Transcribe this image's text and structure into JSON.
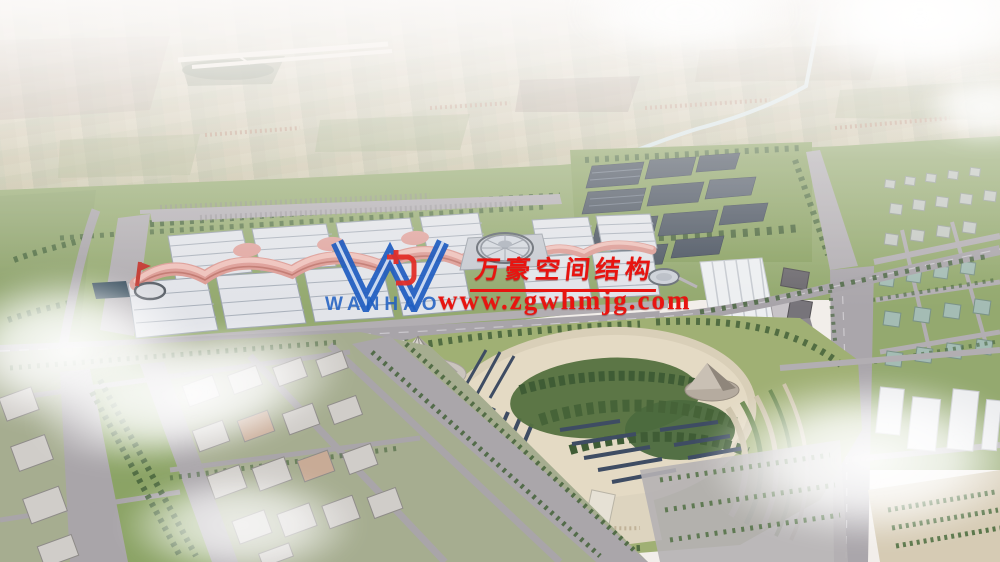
{
  "watermark": {
    "logo_text": "WANHAO",
    "brand_name": "万豪空间结构",
    "website": "www.zgwhmjg.com",
    "text_color": "#e81410",
    "logo_blue": "#1d5ec2",
    "logo_accent_red": "#e22e28"
  },
  "palette": {
    "sky_haze": "#f5f2f0",
    "farmland_tan": "#d9d2bd",
    "greenery": "#94a96f",
    "tree_dark": "#44623a",
    "road_grey": "#a8a4a9",
    "hall_roof_white": "#e2e4e9",
    "membrane_pink": "#dc9a93",
    "dome_grey": "#d4d8df",
    "solar_panel_dark": "#49525f",
    "park_sand": "#e4dac4",
    "pond_water": "#2f4656",
    "building_grey": "#d0cdc9",
    "cloud_white": "#ffffff"
  }
}
